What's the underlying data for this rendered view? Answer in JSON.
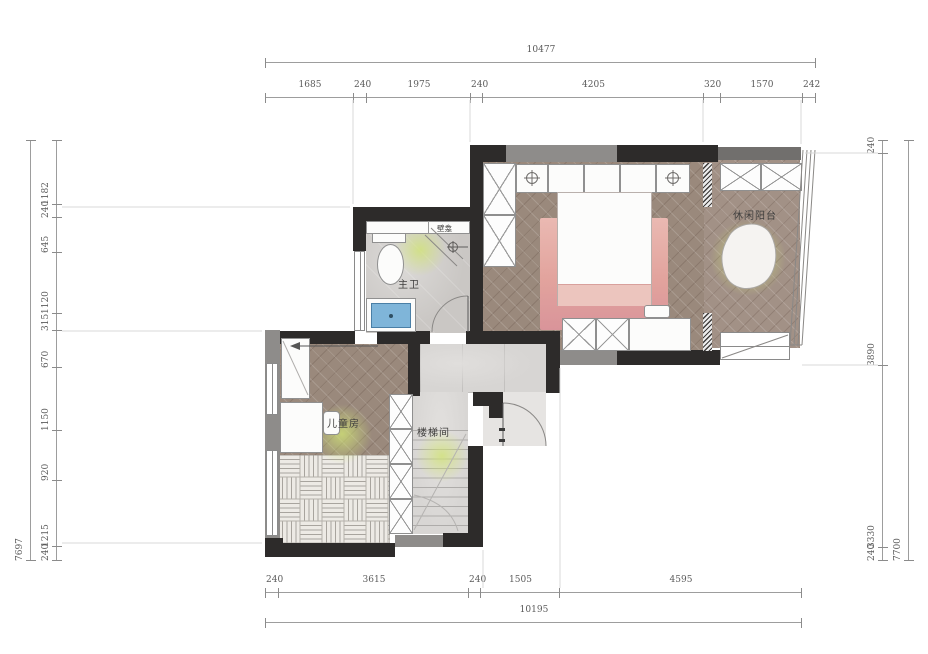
{
  "rooms": {
    "master_bath": "主卫",
    "niche": "壁龛",
    "balcony": "休闲阳台",
    "kids_room": "儿童房",
    "stairwell": "楼梯间"
  },
  "dimensions": {
    "top": {
      "overall": "10477",
      "segments": [
        "1685",
        "240",
        "1975",
        "240",
        "4205",
        "320",
        "1570",
        "242"
      ]
    },
    "bottom": {
      "overall": "10195",
      "segments": [
        "240",
        "3615",
        "240",
        "1505",
        "4595"
      ]
    },
    "left": {
      "overall": "7697",
      "segments": [
        "1182",
        "240",
        "645",
        "1120",
        "315",
        "670",
        "1150",
        "920",
        "1215",
        "240"
      ]
    },
    "right": {
      "overall": "7700",
      "segments": [
        "240",
        "3890",
        "3330",
        "240"
      ]
    }
  },
  "colors": {
    "wall": "#2d2b2a",
    "wall_gray": "#8e8c8a",
    "wood_floor": "#9a897c",
    "tile_floor": "#cac7c4",
    "accent_pink": "#e2a39d",
    "glow": "#d0e276",
    "sink_blue": "#7fb5d9"
  }
}
